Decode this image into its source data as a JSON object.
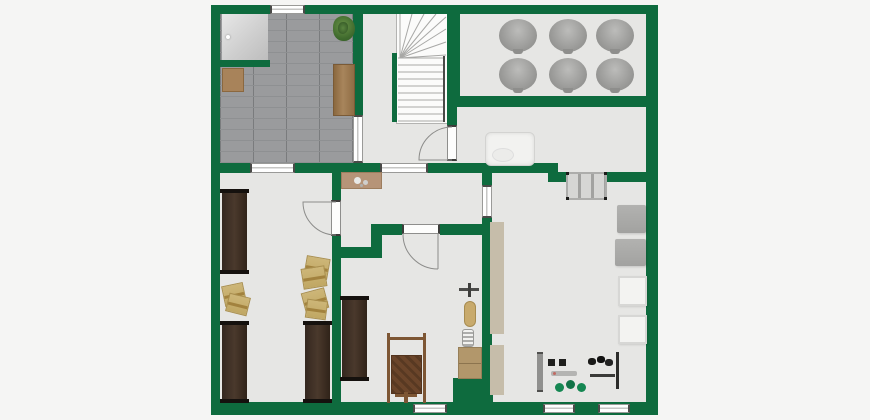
{
  "canvas": {
    "width": 870,
    "height": 420,
    "background": "#f5f5f4"
  },
  "palette": {
    "wall_green": "#0e6b3e",
    "floor_gray": "#e6e6e4",
    "tile_gray": "#9a9b9d",
    "window_white": "#ffffff",
    "bench_brown": "#3b2d24",
    "box_tan": "#c9b272",
    "wood_mid": "#9c7a50",
    "object_gray": "#ababa9",
    "tank_gray": "#9d9d9b",
    "duct_beige": "#c6bdaa",
    "kettlebell_green": "#158752"
  },
  "plan": {
    "floors": [
      {
        "name": "main-floor",
        "cls": "floor",
        "x": 220,
        "y": 14,
        "w": 426,
        "h": 388
      },
      {
        "name": "entrance-tile-floor",
        "cls": "tiles",
        "x": 220,
        "y": 14,
        "w": 133,
        "h": 149
      }
    ],
    "walls": [
      {
        "name": "outer-wall-top",
        "x": 211,
        "y": 5,
        "w": 447,
        "h": 9
      },
      {
        "name": "outer-wall-left",
        "x": 211,
        "y": 5,
        "w": 9,
        "h": 410
      },
      {
        "name": "outer-wall-right",
        "x": 646,
        "y": 5,
        "w": 12,
        "h": 410
      },
      {
        "name": "outer-wall-bottom",
        "x": 211,
        "y": 402,
        "w": 447,
        "h": 13
      },
      {
        "name": "closet-wall",
        "x": 220,
        "y": 60,
        "w": 50,
        "h": 7
      },
      {
        "name": "entrance-stair-wall",
        "x": 353,
        "y": 14,
        "w": 10,
        "h": 101
      },
      {
        "name": "stair-tankroom-wall",
        "x": 447,
        "y": 14,
        "w": 13,
        "h": 93
      },
      {
        "name": "tankroom-bottom-wall",
        "x": 447,
        "y": 96,
        "w": 199,
        "h": 11
      },
      {
        "name": "stair-boiler-wall",
        "x": 447,
        "y": 107,
        "w": 10,
        "h": 18
      },
      {
        "name": "mid-wall-a",
        "x": 220,
        "y": 163,
        "w": 30,
        "h": 10
      },
      {
        "name": "mid-wall-b",
        "x": 295,
        "y": 163,
        "w": 85,
        "h": 10
      },
      {
        "name": "mid-wall-c",
        "x": 428,
        "y": 163,
        "w": 130,
        "h": 10
      },
      {
        "name": "mid-wall-step",
        "x": 548,
        "y": 163,
        "w": 10,
        "h": 19
      },
      {
        "name": "mid-wall-d",
        "x": 558,
        "y": 172,
        "w": 88,
        "h": 10
      },
      {
        "name": "hall-right-wall-upper",
        "x": 482,
        "y": 163,
        "w": 10,
        "h": 22
      },
      {
        "name": "hall-right-wall-lower",
        "x": 482,
        "y": 218,
        "w": 10,
        "h": 160
      },
      {
        "name": "workshop-corner-wall",
        "x": 453,
        "y": 378,
        "w": 40,
        "h": 26
      },
      {
        "name": "storage-wall-upper",
        "x": 332,
        "y": 173,
        "w": 9,
        "h": 27
      },
      {
        "name": "storage-wall-mid",
        "x": 332,
        "y": 236,
        "w": 9,
        "h": 22
      },
      {
        "name": "workshop-step-wall-h",
        "x": 332,
        "y": 247,
        "w": 41,
        "h": 11
      },
      {
        "name": "workshop-step-wall-v",
        "x": 371,
        "y": 224,
        "w": 11,
        "h": 34
      },
      {
        "name": "workshop-top-wall-a",
        "x": 382,
        "y": 224,
        "w": 20,
        "h": 11
      },
      {
        "name": "workshop-top-wall-b",
        "x": 440,
        "y": 224,
        "w": 52,
        "h": 11
      },
      {
        "name": "storage-workshop-wall",
        "x": 332,
        "y": 258,
        "w": 9,
        "h": 144
      },
      {
        "name": "stair-stub-wall",
        "x": 392,
        "y": 53,
        "w": 5,
        "h": 69
      }
    ],
    "windows": [
      {
        "name": "top-window",
        "x": 270,
        "y": 5,
        "w": 35,
        "h": 9,
        "o": "h"
      },
      {
        "name": "interior-window-storage",
        "x": 250,
        "y": 163,
        "w": 45,
        "h": 10,
        "o": "h"
      },
      {
        "name": "interior-window-hall",
        "x": 380,
        "y": 163,
        "w": 48,
        "h": 10,
        "o": "h"
      },
      {
        "name": "interior-window-entrance",
        "x": 353,
        "y": 115,
        "w": 10,
        "h": 48,
        "o": "v"
      },
      {
        "name": "passage-opening",
        "x": 482,
        "y": 185,
        "w": 10,
        "h": 33,
        "o": "v"
      },
      {
        "name": "bottom-window-1",
        "x": 413,
        "y": 404,
        "w": 34,
        "h": 9,
        "o": "h"
      },
      {
        "name": "bottom-window-2",
        "x": 543,
        "y": 404,
        "w": 32,
        "h": 9,
        "o": "h"
      },
      {
        "name": "bottom-window-3",
        "x": 598,
        "y": 404,
        "w": 32,
        "h": 9,
        "o": "h"
      }
    ],
    "doors": [
      {
        "name": "boiler-door",
        "o": "v",
        "frame": {
          "x": 447,
          "y": 125,
          "w": 10,
          "h": 36
        },
        "arc": "M452 160 L419 160 A33 33 0 0 1 452 127"
      },
      {
        "name": "storage-door",
        "o": "v",
        "frame": {
          "x": 331,
          "y": 200,
          "w": 10,
          "h": 36
        },
        "arc": "M336 202 L303 202 A33 33 0 0 0 336 235"
      },
      {
        "name": "workshop-door",
        "o": "h",
        "frame": {
          "x": 402,
          "y": 224,
          "w": 38,
          "h": 10
        },
        "arc": "M438 234 L438 269 M403 234 A35 35 0 0 0 438 269"
      }
    ],
    "stairs": {
      "name": "winder-staircase",
      "x": 396,
      "y": 12,
      "w": 52,
      "h": 112,
      "pivot": [
        4,
        46
      ],
      "tread_y0": 46,
      "tread_y1": 110,
      "tread_step": 7,
      "fan": [
        [
          4,
          2
        ],
        [
          16,
          2
        ],
        [
          28,
          2
        ],
        [
          40,
          2
        ],
        [
          50,
          5
        ],
        [
          50,
          17
        ],
        [
          50,
          30
        ],
        [
          50,
          43
        ]
      ]
    },
    "furniture": [
      {
        "name": "entry-storage-unit",
        "cls": "closet",
        "x": 222,
        "y": 14,
        "w": 46,
        "h": 46
      },
      {
        "name": "potted-plant",
        "cls": "plant",
        "x": 333,
        "y": 16,
        "w": 22,
        "h": 25
      },
      {
        "name": "entry-table",
        "cls": "wood-plank",
        "x": 333,
        "y": 64,
        "w": 22,
        "h": 52
      },
      {
        "name": "entry-cabinet",
        "cls": "wood-cab",
        "x": 222,
        "y": 68,
        "w": 22,
        "h": 24
      },
      {
        "name": "hall-shelf",
        "cls": "shelf-tan",
        "x": 341,
        "y": 172,
        "w": 41,
        "h": 17
      },
      {
        "name": "wall-bench-1",
        "cls": "bench",
        "x": 222,
        "y": 190,
        "w": 25,
        "h": 83
      },
      {
        "name": "wall-bench-2",
        "cls": "bench",
        "x": 222,
        "y": 322,
        "w": 25,
        "h": 80
      },
      {
        "name": "wall-bench-3",
        "cls": "bench",
        "x": 305,
        "y": 322,
        "w": 25,
        "h": 80
      },
      {
        "name": "wall-bench-4",
        "cls": "bench",
        "x": 342,
        "y": 297,
        "w": 25,
        "h": 83
      },
      {
        "name": "storage-box-1",
        "cls": "box",
        "x": 223,
        "y": 284,
        "w": 22,
        "h": 21,
        "rot": -12
      },
      {
        "name": "storage-box-2",
        "cls": "box",
        "x": 227,
        "y": 295,
        "w": 22,
        "h": 19,
        "rot": 14
      },
      {
        "name": "storage-box-3",
        "cls": "box",
        "x": 305,
        "y": 257,
        "w": 24,
        "h": 21,
        "rot": 10
      },
      {
        "name": "storage-box-4",
        "cls": "box",
        "x": 302,
        "y": 267,
        "w": 24,
        "h": 21,
        "rot": -9
      },
      {
        "name": "storage-box-5",
        "cls": "box",
        "x": 303,
        "y": 290,
        "w": 24,
        "h": 21,
        "rot": -15
      },
      {
        "name": "storage-box-6",
        "cls": "box",
        "x": 306,
        "y": 300,
        "w": 21,
        "h": 19,
        "rot": 8
      },
      {
        "name": "wooden-sled",
        "cls": "sled",
        "x": 387,
        "y": 333,
        "w": 39,
        "h": 70
      },
      {
        "name": "sled-crossbar",
        "cls": "brown-bar",
        "x": 389,
        "y": 337,
        "w": 35,
        "h": 3
      },
      {
        "name": "sled-support",
        "cls": "brown-bar",
        "x": 404,
        "y": 392,
        "w": 4,
        "h": 11
      },
      {
        "name": "sled-footbar",
        "cls": "brown-bar",
        "x": 395,
        "y": 394,
        "w": 22,
        "h": 3
      },
      {
        "name": "wall-tool-rack",
        "cls": "tool-dark",
        "x": 459,
        "y": 283,
        "w": 20,
        "h": 14
      },
      {
        "name": "wall-tool",
        "cls": "loaf",
        "x": 464,
        "y": 301,
        "w": 12,
        "h": 26
      },
      {
        "name": "spring-coil",
        "cls": "coil",
        "x": 462,
        "y": 329,
        "w": 12,
        "h": 18
      },
      {
        "name": "workshop-cabinet",
        "cls": "cab-tan",
        "x": 458,
        "y": 347,
        "w": 24,
        "h": 32
      },
      {
        "name": "boiler-appliance",
        "cls": "boiler",
        "x": 485,
        "y": 132,
        "w": 50,
        "h": 34
      },
      {
        "name": "storage-tank-1",
        "cls": "barrel",
        "x": 499,
        "y": 19,
        "w": 38,
        "h": 33
      },
      {
        "name": "storage-tank-2",
        "cls": "barrel",
        "x": 549,
        "y": 19,
        "w": 38,
        "h": 33
      },
      {
        "name": "storage-tank-3",
        "cls": "barrel",
        "x": 596,
        "y": 19,
        "w": 38,
        "h": 33
      },
      {
        "name": "storage-tank-4",
        "cls": "barrel",
        "x": 499,
        "y": 58,
        "w": 38,
        "h": 33
      },
      {
        "name": "storage-tank-5",
        "cls": "barrel",
        "x": 549,
        "y": 58,
        "w": 38,
        "h": 33
      },
      {
        "name": "storage-tank-6",
        "cls": "barrel",
        "x": 596,
        "y": 58,
        "w": 38,
        "h": 33
      },
      {
        "name": "floor-grate",
        "cls": "radiator",
        "x": 566,
        "y": 172,
        "w": 41,
        "h": 28
      },
      {
        "name": "gray-table-1",
        "cls": "gray-box",
        "x": 617,
        "y": 205,
        "w": 29,
        "h": 28
      },
      {
        "name": "gray-table-2",
        "cls": "gray-box",
        "x": 615,
        "y": 239,
        "w": 31,
        "h": 27
      },
      {
        "name": "white-table-1",
        "cls": "white-box",
        "x": 618,
        "y": 276,
        "w": 29,
        "h": 30
      },
      {
        "name": "white-table-2",
        "cls": "white-box",
        "x": 618,
        "y": 315,
        "w": 29,
        "h": 29
      },
      {
        "name": "chimney-duct-1",
        "cls": "duct",
        "x": 490,
        "y": 222,
        "w": 14,
        "h": 112
      },
      {
        "name": "chimney-duct-2",
        "cls": "duct",
        "x": 490,
        "y": 345,
        "w": 14,
        "h": 50
      },
      {
        "name": "gym-bar-rack",
        "cls": "vbar",
        "x": 537,
        "y": 352,
        "w": 6,
        "h": 40
      },
      {
        "name": "dumbbells",
        "cls": "blackbits",
        "x": 548,
        "y": 359,
        "w": 20,
        "h": 7
      },
      {
        "name": "barbell",
        "cls": "graybar",
        "x": 551,
        "y": 371,
        "w": 26,
        "h": 5
      },
      {
        "name": "kettlebells",
        "cls": "greenbits",
        "x": 553,
        "y": 379,
        "w": 34,
        "h": 15
      },
      {
        "name": "weight-plates",
        "cls": "blackbits2",
        "x": 588,
        "y": 356,
        "w": 26,
        "h": 11
      },
      {
        "name": "gym-bar",
        "cls": "darkbar",
        "x": 590,
        "y": 374,
        "w": 25,
        "h": 3
      },
      {
        "name": "gym-rail",
        "cls": "vline",
        "x": 616,
        "y": 352,
        "w": 3,
        "h": 37
      }
    ]
  }
}
